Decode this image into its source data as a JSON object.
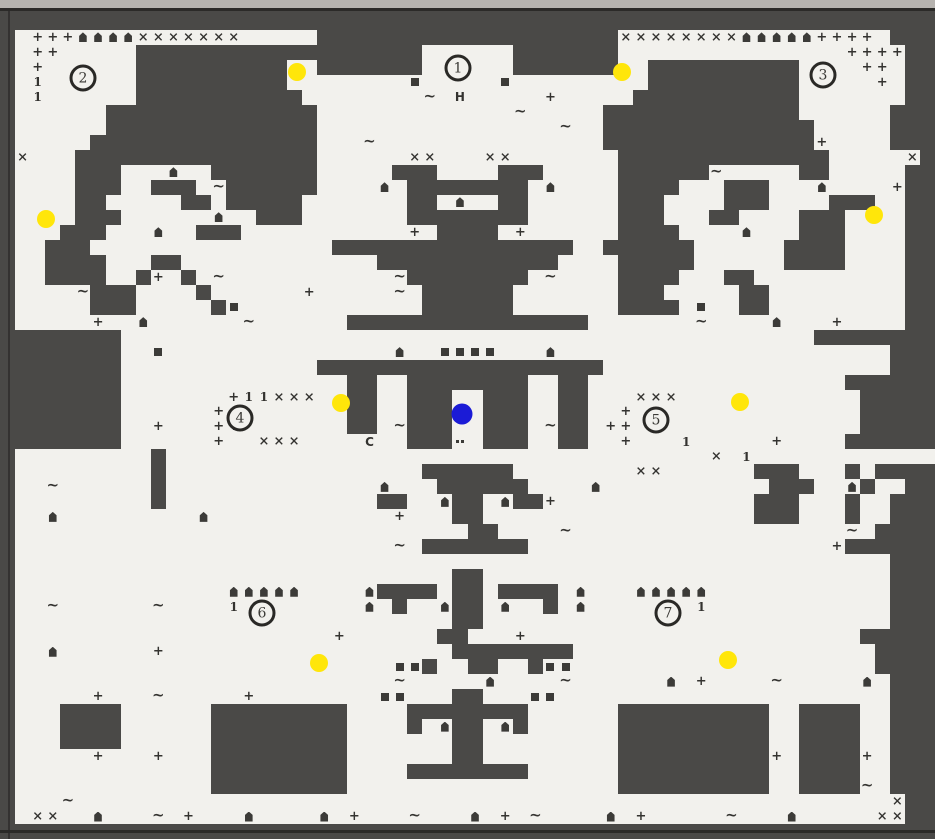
{
  "map": {
    "kind": "scanned dungeon level map, tile-based, near mirror-symmetric",
    "cols": 62,
    "rows": 56,
    "legend": {
      "#": "wall (dark)",
      ".": "floor (light)",
      "+": "plus symbol",
      "~": "tilde/water symbol",
      "x": "serif-x symbol",
      "h": "hut symbol",
      "s": "small dark block",
      "1": "serif-one symbol",
      "H": "letter H",
      "C": "letter C",
      ":": "double-dot mark"
    },
    "tiles": [
      "##############################################################",
      "##############################################################",
      "#.+++hhhhxxxxxxx.....####################xxxxxxxxhhhhh++++.###",
      "#.++.....###################......#######...............++++##",
      "#.+......##########..#######......#######..##########....++.##",
      "#.1......##########........s.....s.........##########.....+.##",
      "#.1......###########........~.H.....+.....###########.......##",
      "#......##############.............~.....#############......###",
      "#......##############................~..##############.....###",
      "#.....###############...~...............##############+....###",
      "#x...################......xx...xx.......##############.....x#",
      "#....###...h..#######.....###....###.....######~.....##.....##",
      "#....###..###.~######....h.########.h....####...###...h....+##",
      "#....##.....##.#####.......##.h..##......###....###....###..##",
      "#....###......h..###.......########......###...##....###....##",
      "#...###...h..###...........+.####.+......####....h...###....##",
      "#..###................################..######......####....#",
      "#..####...##.............############....#####......####....#",
      "#..####..#+.#.~...........~########.~....####...##..........##",
      "#....~###....#......+.....~.######.......###.....##.........##",
      "#.....###.....#s............######.......####.s..##.........##",
      "#.....+..h......~......################.......~....h...+....##",
      "########..............................................…###",
      "########..s...............h..ssss...h......................###",
      "########.............###################...................###",
      "########...............##..########..##.................#####",
      "########.......+11xxx..##..###..###..##...xxx............#####",
      "########......++.......##..###..###..##..+...............#####",
      "########..+...++.......##.~###..###.~##.++...............#####",
      "########......+..xxx....C..###:.###..##..+...1.....+....######",
      "#.........#....................................x.1............#####",
      "#.........#.................######........xx......###...#.####",
      "#..~......#..............h...######....h...........###..h#..###",
      "#.........#..............##..h##.h##+.............###...#..###",
      "#..h.........h............+...##..................###...#..###",
      "#..............................##....~..................~.###",
      "#.........................~.#######....................+##",
      "#..........................................................###",
      "#.............................##...........................###",
      "#..............hhhhh....h####.##.####.h...hhhhh............###",
      "#..~......~....1........h.#..h##.h..#.h.......1............###",
      "#.............................##...........................###",
      "#.....................+......##...+......................###",
      "#..h......+...................########....................###",
      "#.........................ss#..##..#ss....................###",
      "#.........................~.....h....~......h.+....~.....h.###",
      "#.....+...~.....+........ss...##...ss......................###",
      "#...####......#########....########......##########..####..###",
      "#...####......#########....#.h##.h#......##########..####..###",
      "#...####......#########.......##.........##########..####..###",
      "#.....+...+...#########.......##.........##########+.####+.###",
      "#.............#########....########......##########..####..###",
      "#.............#########..................##########..####~.###",
      "#...~......................................................x##",
      "#.xx..h...~.+...h....h.+...~...h.+.~....h.+.....~...h.....xx##",
      "##############################################################"
    ],
    "letters_on_map": [
      "H",
      "C"
    ]
  },
  "markers": {
    "numbered_locations": [
      {
        "label": "1",
        "x": 458,
        "y": 68
      },
      {
        "label": "2",
        "x": 83,
        "y": 78
      },
      {
        "label": "3",
        "x": 823,
        "y": 75
      },
      {
        "label": "4",
        "x": 240,
        "y": 418
      },
      {
        "label": "5",
        "x": 656,
        "y": 420
      },
      {
        "label": "6",
        "x": 262,
        "y": 613
      },
      {
        "label": "7",
        "x": 668,
        "y": 613
      }
    ],
    "yellow_dots": [
      {
        "x": 297,
        "y": 72
      },
      {
        "x": 622,
        "y": 72
      },
      {
        "x": 46,
        "y": 219
      },
      {
        "x": 874,
        "y": 215
      },
      {
        "x": 341,
        "y": 403
      },
      {
        "x": 740,
        "y": 402
      },
      {
        "x": 319,
        "y": 663
      },
      {
        "x": 728,
        "y": 660
      }
    ],
    "blue_dot": {
      "x": 462,
      "y": 414
    }
  },
  "colors": {
    "wall": "#4a4947",
    "floor": "#f2f1ed",
    "symbol": "#343330",
    "yellow": "#ffe60a",
    "blue": "#1b1bd6",
    "scan_strip": "#b6b3af",
    "scan_line": "#2b2a28"
  }
}
